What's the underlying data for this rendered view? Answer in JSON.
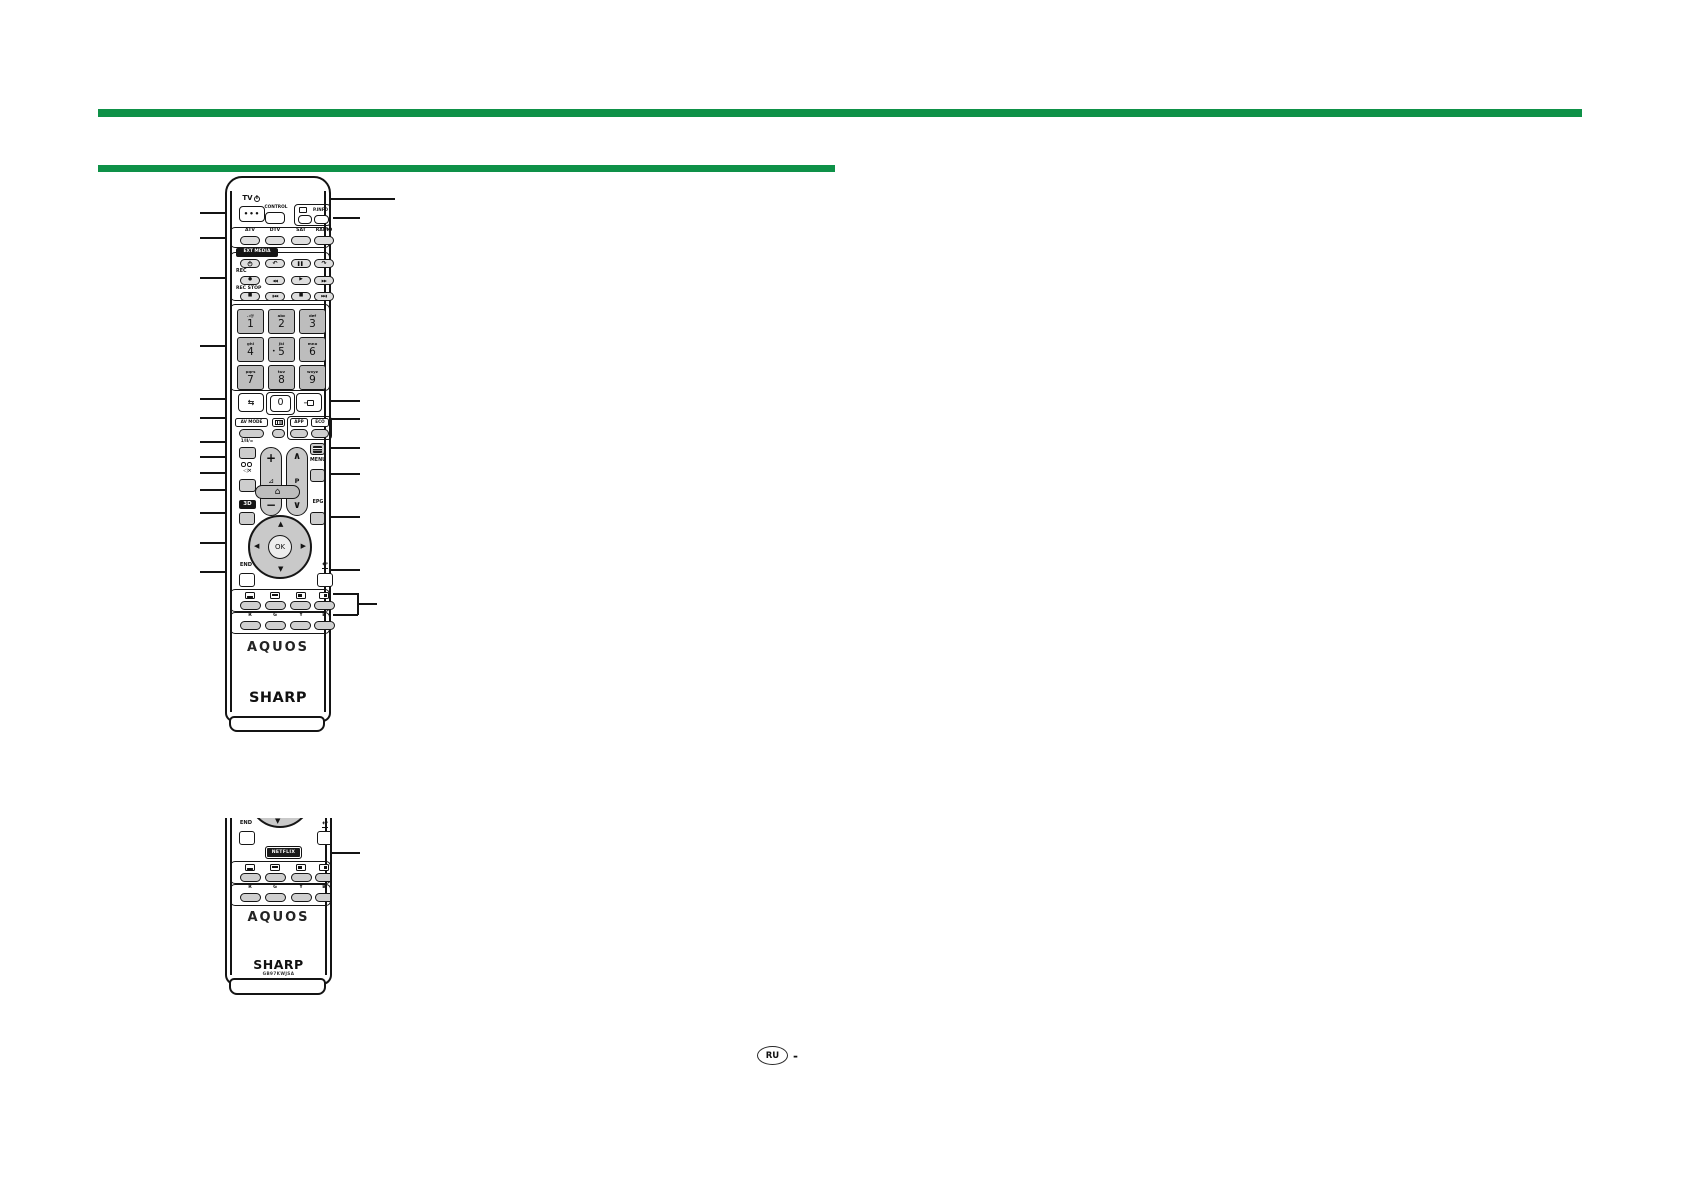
{
  "page": {
    "accent_green": "#0e9148",
    "footer_region": "RU",
    "footer_dash": "-"
  },
  "remote_full": {
    "tv_label": "TV",
    "power_dots": "•••",
    "control_label": "CONTROL",
    "pinfo_label": "P.INFO",
    "sources": [
      "ATV",
      "DTV",
      "SAT",
      "RADIO"
    ],
    "ext_media_label": "EXT MEDIA",
    "rec_label": "REC",
    "rec_stop_label": "REC STOP",
    "media_row1": {
      "replay": "↶",
      "pause": "▌▌",
      "skip": "↷"
    },
    "media_row2": [
      "●",
      "◀◀",
      "▶",
      "▶▶"
    ],
    "media_row3": [
      "■",
      "▮◀◀",
      "■",
      "▶▶▮"
    ],
    "keys": [
      {
        "digit": "1",
        "letters": ".:@"
      },
      {
        "digit": "2",
        "letters": "abc"
      },
      {
        "digit": "3",
        "letters": "def"
      },
      {
        "digit": "4",
        "letters": "ghi"
      },
      {
        "digit": "5",
        "letters": "jkl"
      },
      {
        "digit": "6",
        "letters": "mno"
      },
      {
        "digit": "7",
        "letters": "pqrs"
      },
      {
        "digit": "8",
        "letters": "tuv"
      },
      {
        "digit": "9",
        "letters": "wxyz"
      },
      {
        "digit": "0",
        "letters": ""
      }
    ],
    "key_dot": "•",
    "flashback_glyph": "⇆",
    "input_glyph": "→",
    "av_mode_label": "AV MODE",
    "app_label": "APP",
    "eco_label": "ECO",
    "audio_select_label": "1/II/=",
    "mute_glyph": "◁×",
    "volume_plus": "+",
    "volume_icon": "⊿",
    "volume_minus": "−",
    "channel_up": "∧",
    "channel_label": "P",
    "channel_down": "∨",
    "menu_label": "MENU",
    "home_glyph": "⌂",
    "three_d_label": "3D",
    "epg_label": "EPG",
    "nav_up": "▲",
    "nav_down": "▼",
    "nav_left": "◀",
    "nav_right": "▶",
    "ok_label": "OK",
    "end_label": "END",
    "return_glyph": "↩",
    "color_key_labels": [
      "R",
      "G",
      "Y",
      "B"
    ],
    "brand": "AQUOS",
    "maker_logo": "SHARP"
  },
  "remote_partial": {
    "nav_down": "▼",
    "end_label": "END",
    "return_glyph": "↩",
    "netflix_label": "NETFLIX",
    "color_key_labels": [
      "R",
      "G",
      "Y",
      "B"
    ],
    "brand": "AQUOS",
    "maker_logo": "SHARP",
    "model_code": "GB97KWJSA"
  }
}
